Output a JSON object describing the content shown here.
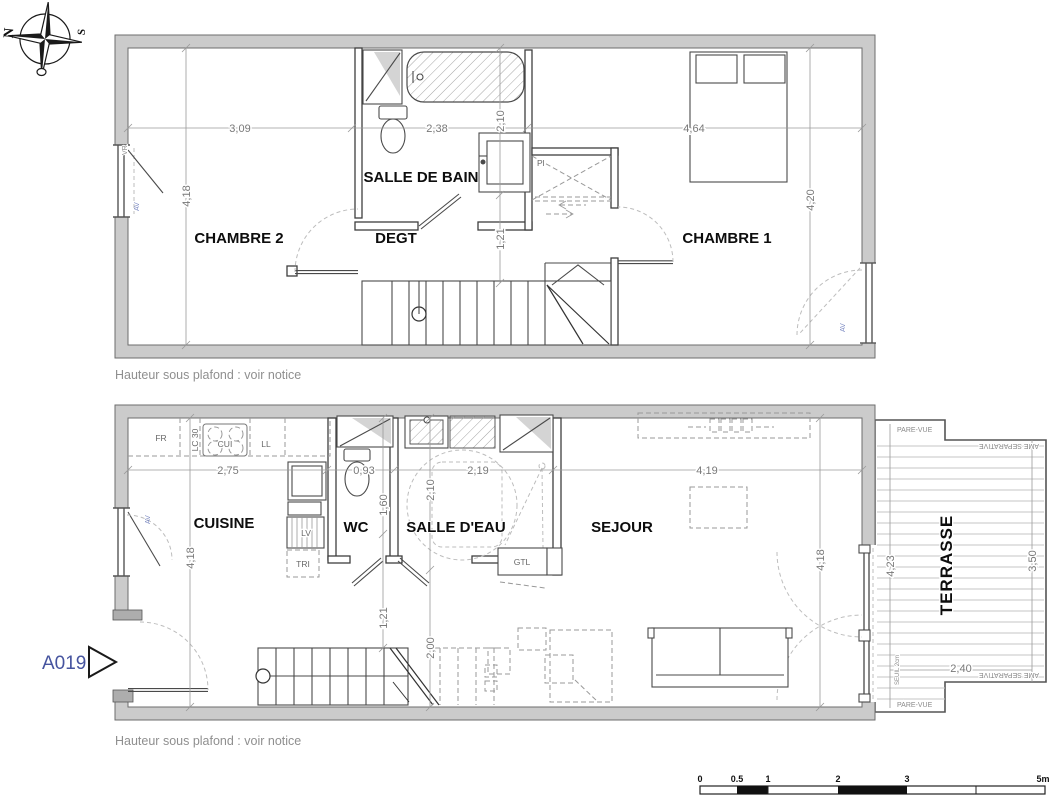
{
  "compass": {
    "north": "N",
    "south": "S"
  },
  "entry_marker": {
    "ref": "A019"
  },
  "upper_floor": {
    "rooms": [
      {
        "label": "CHAMBRE 2"
      },
      {
        "label": "DEGT"
      },
      {
        "label": "SALLE DE BAIN"
      },
      {
        "label": "CHAMBRE 1"
      }
    ],
    "closet_label": "Pl",
    "dims": {
      "h_chambre2": "3,09",
      "h_sdb": "2,38",
      "h_chambre1": "4,64",
      "v_left": "4,18",
      "v_bath": "2,10",
      "v_degt": "1,21",
      "v_right": "4,20"
    },
    "window_labels": {
      "left_top": "VR",
      "left": "AV",
      "right": "AV"
    },
    "note": "Hauteur sous plafond : voir notice"
  },
  "lower_floor": {
    "rooms": [
      {
        "label": "CUISINE"
      },
      {
        "label": "WC"
      },
      {
        "label": "SALLE D'EAU"
      },
      {
        "label": "SEJOUR"
      },
      {
        "label": "TERRASSE"
      }
    ],
    "kitchen_labels": {
      "fr": "FR",
      "lc": "LC 30",
      "cui": "CUI",
      "ll": "LL",
      "lv": "LV",
      "tri": "TRI"
    },
    "gtl_label": "GTL",
    "dims": {
      "h_cuisine": "2,75",
      "h_wc": "0,93",
      "h_sde": "2,19",
      "h_sejour": "4,19",
      "v_left": "4,18",
      "v_wc": "1,60",
      "v_sde": "2,10",
      "v_stair": "1,21",
      "v_stair2": "2,00",
      "v_right": "4,18"
    },
    "window_label_left": "AV",
    "terrace": {
      "pare_vue_top": "PARE-VUE",
      "pare_vue_bottom": "PARE-VUE",
      "separative_top": "AME SEPARATIVE",
      "separative_bottom": "AME SEPARATIVE",
      "seuil": "SEUIL 2cm",
      "dim_left": "4,23",
      "dim_right": "3,50",
      "dim_width": "2,40"
    },
    "note": "Hauteur sous plafond : voir notice"
  },
  "scale_bar": {
    "labels": [
      "0",
      "0.5",
      "1",
      "2",
      "3",
      "5m"
    ]
  },
  "colors": {
    "wall_fill": "#cbcbcb",
    "line": "#3e3e3e",
    "dim_text": "#787878",
    "marker_blue": "#46549f",
    "window_label_blue": "#7b89c2",
    "muted": "#8f8f8f"
  }
}
